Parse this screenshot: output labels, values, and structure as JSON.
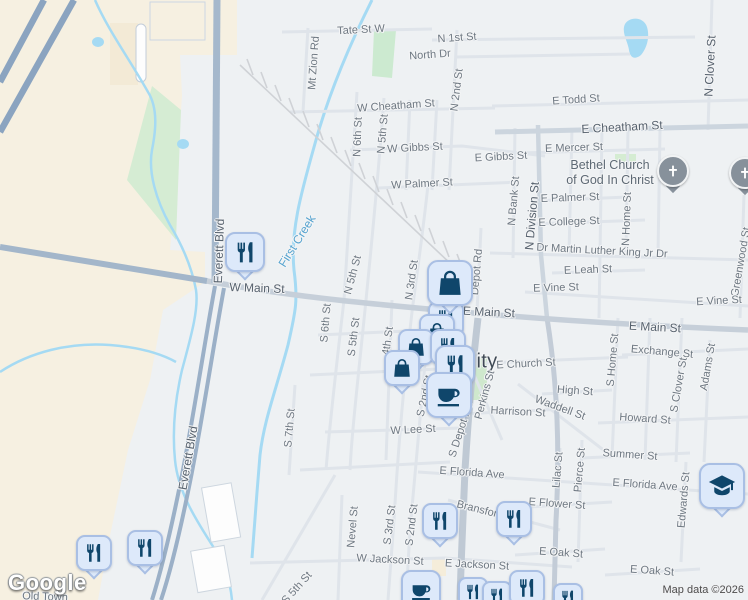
{
  "attribution": {
    "logo": "Google",
    "map_data": "Map data ©2026"
  },
  "city_partial_label": "ity",
  "colors": {
    "background": "#eef1f3",
    "land_beige": "#f6f0e1",
    "park_green": "#d5ecd3",
    "water": "#a5daf3",
    "road_minor": "#dfe4ea",
    "road_medium": "#ccd5de",
    "road_major": "#a5b8cc",
    "highway": "#8ba4c0",
    "railroad": "#d0d3d8",
    "marker_fill": "#dde9fa",
    "marker_border": "#a9bfe4",
    "marker_icon": "#0f466b",
    "church_pin": "#87919b",
    "label_gray": "#6e7882",
    "water_label": "#55a3cf"
  },
  "map": {
    "labels": [
      {
        "t": "Tate St W",
        "x": 361,
        "y": 30,
        "r": -3,
        "c": "st"
      },
      {
        "t": "N 1st St",
        "x": 457,
        "y": 38,
        "r": -4,
        "c": "st"
      },
      {
        "t": "North Dr",
        "x": 430,
        "y": 55,
        "r": -4,
        "c": "st"
      },
      {
        "t": "Mt Zion Rd",
        "x": 314,
        "y": 63,
        "r": -86,
        "c": "st"
      },
      {
        "t": "W Cheatham St",
        "x": 396,
        "y": 106,
        "r": -4,
        "c": "st"
      },
      {
        "t": "E Todd St",
        "x": 576,
        "y": 100,
        "r": -4,
        "c": "st"
      },
      {
        "t": "E Cheatham St",
        "x": 622,
        "y": 127,
        "r": -3,
        "c": "stb"
      },
      {
        "t": "N 2nd St",
        "x": 457,
        "y": 90,
        "r": -83,
        "c": "st"
      },
      {
        "t": "N Clover St",
        "x": 710,
        "y": 66,
        "r": -87,
        "c": "stb"
      },
      {
        "t": "N 6th St",
        "x": 358,
        "y": 137,
        "r": -88,
        "c": "st"
      },
      {
        "t": "N 5th St",
        "x": 383,
        "y": 134,
        "r": -85,
        "c": "st"
      },
      {
        "t": "W Gibbs St",
        "x": 415,
        "y": 148,
        "r": -3,
        "c": "st"
      },
      {
        "t": "E Gibbs St",
        "x": 501,
        "y": 157,
        "r": -3,
        "c": "st"
      },
      {
        "t": "E Mercer St",
        "x": 574,
        "y": 148,
        "r": -2,
        "c": "st"
      },
      {
        "t": "Bethel Church",
        "x": 610,
        "y": 165,
        "r": 0,
        "c": "poi"
      },
      {
        "t": "of God In Christ",
        "x": 610,
        "y": 180,
        "r": 0,
        "c": "poi"
      },
      {
        "t": "W Palmer St",
        "x": 422,
        "y": 184,
        "r": -3,
        "c": "st"
      },
      {
        "t": "E Palmer St",
        "x": 570,
        "y": 198,
        "r": -2,
        "c": "st"
      },
      {
        "t": "N Bank St",
        "x": 514,
        "y": 201,
        "r": -85,
        "c": "st"
      },
      {
        "t": "N Division St",
        "x": 532,
        "y": 216,
        "r": -85,
        "c": "stb"
      },
      {
        "t": "E College St",
        "x": 569,
        "y": 222,
        "r": -2,
        "c": "st"
      },
      {
        "t": "N Home St",
        "x": 627,
        "y": 219,
        "r": -88,
        "c": "st"
      },
      {
        "t": "Greenwood St",
        "x": 741,
        "y": 262,
        "r": -80,
        "c": "st"
      },
      {
        "t": "Dr Martin Luther King Jr Dr",
        "x": 602,
        "y": 251,
        "r": 3,
        "c": "st"
      },
      {
        "t": "Depot Rd",
        "x": 477,
        "y": 272,
        "r": -85,
        "c": "st"
      },
      {
        "t": "E Leah St",
        "x": 588,
        "y": 270,
        "r": -2,
        "c": "st"
      },
      {
        "t": "E Vine St",
        "x": 556,
        "y": 288,
        "r": -2,
        "c": "st"
      },
      {
        "t": "E Vine St",
        "x": 719,
        "y": 301,
        "r": -3,
        "c": "st"
      },
      {
        "t": "First Creek",
        "x": 297,
        "y": 241,
        "r": -58,
        "c": "water"
      },
      {
        "t": "Everett Blvd",
        "x": 219,
        "y": 251,
        "r": -88,
        "c": "stb"
      },
      {
        "t": "Everett Blvd",
        "x": 188,
        "y": 458,
        "r": -80,
        "c": "stb"
      },
      {
        "t": "W Main St",
        "x": 257,
        "y": 288,
        "r": 2,
        "c": "stb"
      },
      {
        "t": "E Main St",
        "x": 489,
        "y": 312,
        "r": 3,
        "c": "stb"
      },
      {
        "t": "E Main St",
        "x": 655,
        "y": 327,
        "r": 3,
        "c": "stb"
      },
      {
        "t": "N 3rd St",
        "x": 412,
        "y": 280,
        "r": -82,
        "c": "st"
      },
      {
        "t": "N 5th St",
        "x": 353,
        "y": 275,
        "r": -75,
        "c": "st"
      },
      {
        "t": "S 6th St",
        "x": 326,
        "y": 323,
        "r": -85,
        "c": "st"
      },
      {
        "t": "S 5th St",
        "x": 354,
        "y": 337,
        "r": -83,
        "c": "st"
      },
      {
        "t": "4th St",
        "x": 388,
        "y": 341,
        "r": -82,
        "c": "st"
      },
      {
        "t": "S 2nd St",
        "x": 425,
        "y": 396,
        "r": -78,
        "c": "st"
      },
      {
        "t": "S 7th St",
        "x": 290,
        "y": 428,
        "r": -85,
        "c": "st"
      },
      {
        "t": "ity",
        "x": 487,
        "y": 362,
        "r": 0,
        "c": "city"
      },
      {
        "t": "E Church St",
        "x": 526,
        "y": 364,
        "r": -3,
        "c": "st"
      },
      {
        "t": "Exchange St",
        "x": 662,
        "y": 352,
        "r": 5,
        "c": "st"
      },
      {
        "t": "S Home St",
        "x": 613,
        "y": 360,
        "r": -85,
        "c": "st"
      },
      {
        "t": "High St",
        "x": 575,
        "y": 391,
        "r": 4,
        "c": "st"
      },
      {
        "t": "Waddell St",
        "x": 560,
        "y": 408,
        "r": 20,
        "c": "st"
      },
      {
        "t": "Harrison St",
        "x": 518,
        "y": 412,
        "r": 3,
        "c": "st"
      },
      {
        "t": "Howard St",
        "x": 645,
        "y": 419,
        "r": 4,
        "c": "st"
      },
      {
        "t": "S Clover St",
        "x": 679,
        "y": 385,
        "r": -80,
        "c": "st"
      },
      {
        "t": "Adams St",
        "x": 708,
        "y": 367,
        "r": -80,
        "c": "st"
      },
      {
        "t": "Perkins St",
        "x": 485,
        "y": 395,
        "r": -75,
        "c": "st"
      },
      {
        "t": "S Depot Rd",
        "x": 461,
        "y": 430,
        "r": -72,
        "c": "st"
      },
      {
        "t": "W Lee St",
        "x": 413,
        "y": 430,
        "r": -3,
        "c": "st"
      },
      {
        "t": "E Florida Ave",
        "x": 472,
        "y": 473,
        "r": 4,
        "c": "st"
      },
      {
        "t": "E Florida Ave",
        "x": 645,
        "y": 485,
        "r": 4,
        "c": "st"
      },
      {
        "t": "Summer St",
        "x": 630,
        "y": 455,
        "r": 4,
        "c": "st"
      },
      {
        "t": "Lilac St",
        "x": 558,
        "y": 470,
        "r": -85,
        "c": "st"
      },
      {
        "t": "Pierce St",
        "x": 580,
        "y": 470,
        "r": -85,
        "c": "st"
      },
      {
        "t": "Edwards St",
        "x": 684,
        "y": 500,
        "r": -85,
        "c": "st"
      },
      {
        "t": "E Flower St",
        "x": 557,
        "y": 504,
        "r": 4,
        "c": "st"
      },
      {
        "t": "E Oak St",
        "x": 561,
        "y": 553,
        "r": 4,
        "c": "st"
      },
      {
        "t": "E Oak St",
        "x": 652,
        "y": 571,
        "r": 4,
        "c": "st"
      },
      {
        "t": "Bransford",
        "x": 480,
        "y": 510,
        "r": 14,
        "c": "st"
      },
      {
        "t": "Nevel St",
        "x": 353,
        "y": 527,
        "r": -85,
        "c": "st"
      },
      {
        "t": "S 3rd St",
        "x": 390,
        "y": 525,
        "r": -83,
        "c": "st"
      },
      {
        "t": "S 2nd St",
        "x": 412,
        "y": 525,
        "r": -83,
        "c": "st"
      },
      {
        "t": "W Jackson St",
        "x": 390,
        "y": 560,
        "r": 3,
        "c": "st"
      },
      {
        "t": "E Jackson St",
        "x": 477,
        "y": 565,
        "r": 3,
        "c": "st"
      },
      {
        "t": "S 5th St",
        "x": 297,
        "y": 588,
        "r": -48,
        "c": "st"
      },
      {
        "t": "Old Town",
        "x": 45,
        "y": 597,
        "r": 2,
        "c": "st"
      }
    ],
    "markers": [
      {
        "type": "restaurant",
        "icon": "fork-knife-icon",
        "x": 446,
        "y": 319,
        "s": "md"
      },
      {
        "type": "shopping",
        "icon": "shopping-bag-icon",
        "x": 437,
        "y": 332,
        "s": "md"
      },
      {
        "type": "shopping",
        "icon": "shopping-bag-icon",
        "x": 416,
        "y": 347,
        "s": "md"
      },
      {
        "type": "restaurant",
        "icon": "fork-knife-icon",
        "x": 448,
        "y": 347,
        "s": "md"
      },
      {
        "type": "shopping",
        "icon": "shopping-bag-icon",
        "x": 402,
        "y": 368,
        "s": "md"
      },
      {
        "type": "restaurant",
        "icon": "fork-knife-icon",
        "x": 455,
        "y": 365,
        "s": "lg"
      },
      {
        "type": "shopping",
        "icon": "shopping-bag-icon",
        "x": 450,
        "y": 283,
        "s": "xl"
      },
      {
        "type": "coffee",
        "icon": "coffee-cup-icon",
        "x": 449,
        "y": 395,
        "s": "xl"
      },
      {
        "type": "restaurant",
        "icon": "fork-knife-icon",
        "x": 245,
        "y": 252,
        "s": "lg"
      },
      {
        "type": "restaurant",
        "icon": "fork-knife-icon",
        "x": 440,
        "y": 521,
        "s": "md"
      },
      {
        "type": "restaurant",
        "icon": "fork-knife-icon",
        "x": 514,
        "y": 519,
        "s": "md"
      },
      {
        "type": "restaurant",
        "icon": "fork-knife-icon",
        "x": 94,
        "y": 553,
        "s": "md"
      },
      {
        "type": "restaurant",
        "icon": "fork-knife-icon",
        "x": 145,
        "y": 548,
        "s": "md"
      },
      {
        "type": "coffee",
        "icon": "coffee-cup-icon",
        "x": 421,
        "y": 590,
        "s": "lg"
      },
      {
        "type": "restaurant",
        "icon": "fork-knife-icon",
        "x": 473,
        "y": 592,
        "s": "sm"
      },
      {
        "type": "restaurant",
        "icon": "fork-knife-icon",
        "x": 497,
        "y": 596,
        "s": "sm"
      },
      {
        "type": "restaurant",
        "icon": "fork-knife-icon",
        "x": 527,
        "y": 588,
        "s": "md"
      },
      {
        "type": "restaurant",
        "icon": "fork-knife-icon",
        "x": 568,
        "y": 598,
        "s": "sm"
      },
      {
        "type": "church",
        "icon": "cross-icon",
        "x": 673,
        "y": 171,
        "s": "church"
      },
      {
        "type": "church",
        "icon": "cross-icon",
        "x": 745,
        "y": 173,
        "s": "church"
      },
      {
        "type": "graduation",
        "icon": "graduation-cap-icon",
        "x": 722,
        "y": 486,
        "s": "xl"
      }
    ]
  }
}
